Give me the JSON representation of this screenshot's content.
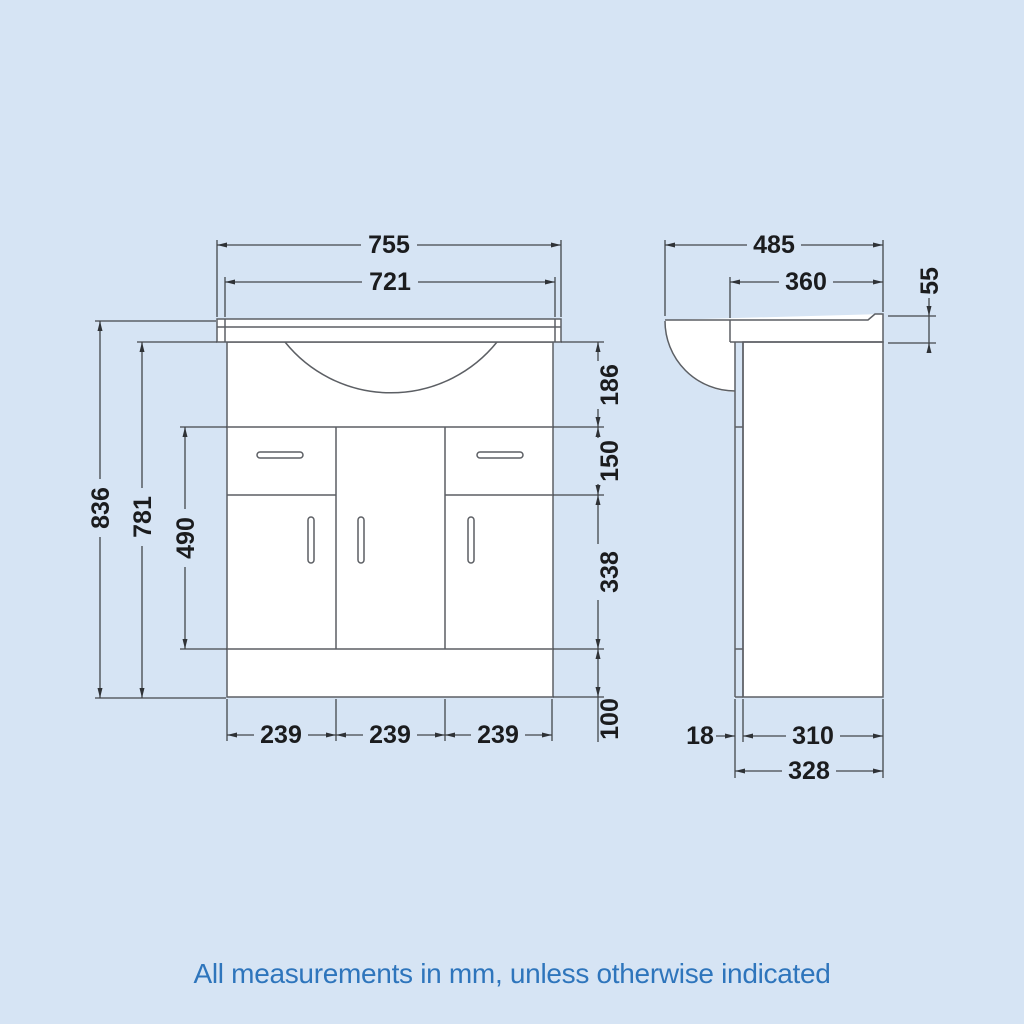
{
  "footer": {
    "note": "All measurements in mm, unless otherwise indicated"
  },
  "diagram": {
    "units": "mm",
    "colors": {
      "background": "#d6e4f4",
      "object_line": "#5c5f64",
      "dimension_line": "#43464a",
      "dimension_text": "#1b1c1e",
      "note_text": "#2e75bc"
    },
    "front_view": {
      "overall_width": "755",
      "inner_width": "721",
      "overall_height": "836",
      "cabinet_height": "781",
      "front_panel_height": "490",
      "basin_section_height": "186",
      "drawer_height": "150",
      "door_height": "338",
      "plinth_height": "100",
      "panel_widths": [
        "239",
        "239",
        "239"
      ]
    },
    "side_view": {
      "overall_depth": "485",
      "top_depth": "360",
      "worktop_height": "55",
      "panel_thickness": "18",
      "carcass_depth": "310",
      "base_depth": "328"
    }
  }
}
